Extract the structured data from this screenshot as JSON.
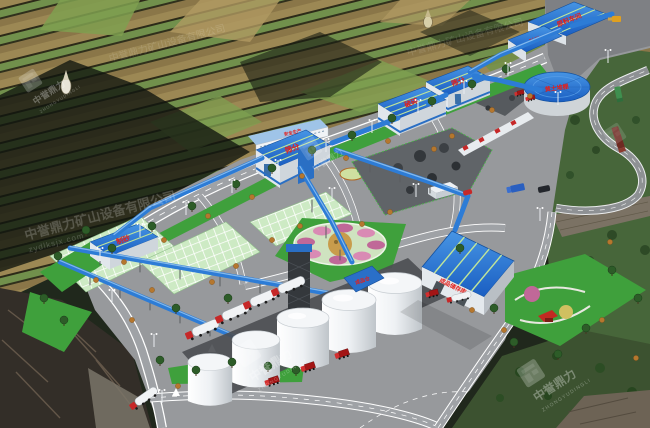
{
  "scene": {
    "type": "3D aerial rendering",
    "subject": "Mountain-side aggregate crushing, screening and sand-making plant with terraced fields behind"
  },
  "plant_labels": {
    "raw_material_shed": "原料车间",
    "crushing": "破碎",
    "screening": "筛分",
    "sand_making": "制砂",
    "round_stockpile_shed": "黄土堆棚",
    "silo_head": "成品仓",
    "finished_warehouse": "成品储存库",
    "office_banner": "安全生产"
  },
  "watermark": {
    "brand_cn": "中誉鼎力",
    "brand_en": "ZHONGYUDINGLI",
    "company_line": "中誉鼎力矿山设备有限公司",
    "website": "zydlksjx.com"
  },
  "palette": {
    "roof_blue": "#2272d2",
    "conveyor_blue": "#2d7cd6",
    "label_red": "#e41f1a",
    "grass_green": "#3fa03c",
    "road_gray": "#9a9ca0",
    "terrace_tan": "#a08a58",
    "terrace_green": "#71904c",
    "silo_white": "#eef1f4"
  },
  "vehicles": {
    "parked_tanker_trucks": 4,
    "red_dump_trucks": 3,
    "warehouse_front_trucks": 2,
    "hill_road_trucks": 2,
    "wheel_loader": 1
  }
}
